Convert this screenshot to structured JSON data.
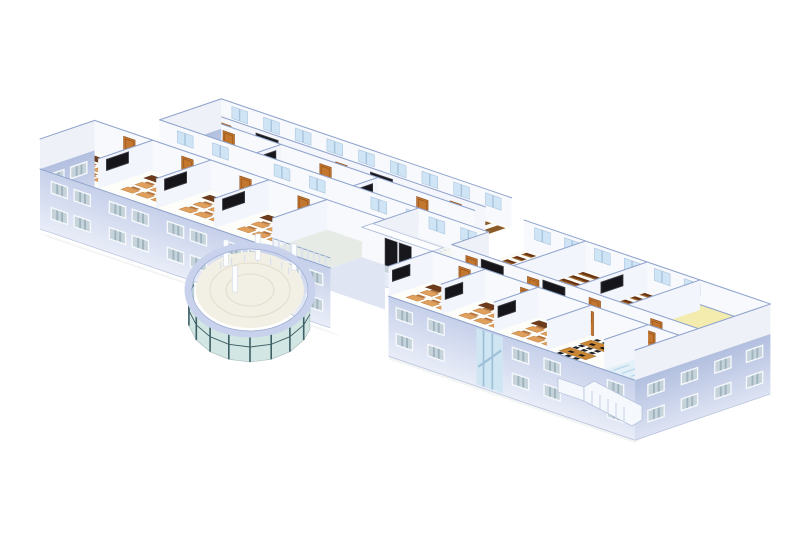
{
  "palette": {
    "edge": "#8fa3cc",
    "edgeSoft": "#b8c4dd",
    "wallIn": "#f7f9fd",
    "wallIn2": "#eef1f8",
    "part": "#f2f5fb",
    "floorRoom": "#fdfdfa",
    "floorWarm": "#fbfbf6",
    "corridor": "#e6ebe6",
    "tileLine": "#ccd4cc",
    "ground": "#e3e7ee",
    "facadeHi": "#c6d0ea",
    "facadeLo": "#e9edf8",
    "facadeSideHi": "#b2bfdf",
    "facadeSideLo": "#dde3f3",
    "winFrame": "#f6f9fc",
    "winGlass": "#c6d3da",
    "winStripe": "#9fb4be",
    "winHi": "#cfe4f4",
    "door": "#c2762e",
    "doorDark": "#8e4f1b",
    "board": "#15151a",
    "tdesk": "#6e3c1d",
    "deskTop": "#e0a05c",
    "deskSide": "#b4733a",
    "lseat": "#6a3312",
    "lseatHi": "#a06a2f",
    "shelf": "#8a5a28",
    "otable": "#c98736",
    "ochair": "#1e1e22",
    "screen": "#2456c4",
    "chairRed": "#d23c22",
    "plant": "#3c9c40",
    "plantPot": "#a66a2e",
    "yellowFloor": "#faf3c8",
    "yellowWall": "#f3ecae",
    "glass": "#cfe4e1",
    "mullion": "#3d5f66",
    "ring": "#c8d2ec",
    "ringEdge": "#9fb0d4",
    "column": "#fcfdff",
    "railing": "#d9e0ee",
    "stair": "#f5f8fd",
    "mat": "#f0e87a",
    "matEdge": "#d8cf4e",
    "canopy": "#fcfdff",
    "glazing": "#cfe6f2",
    "glazingStripe": "#9fc0d8",
    "washFloor": "#e4f0f7",
    "washStall": "#badbeb",
    "background": "#ffffff"
  },
  "scene": {
    "background": "#ffffff",
    "view": "isometric cutaway rendering of a school building, top floor exposed",
    "left_front_wing": {
      "rooms": [
        {
          "type": "classroom",
          "furniture": [
            "student-desks",
            "teacher-desk",
            "blackboard"
          ]
        },
        {
          "type": "classroom",
          "furniture": [
            "student-desks",
            "teacher-desk",
            "blackboard"
          ]
        },
        {
          "type": "classroom",
          "furniture": [
            "student-desks",
            "teacher-desk",
            "blackboard"
          ]
        },
        {
          "type": "classroom",
          "furniture": [
            "student-desks",
            "teacher-desk",
            "blackboard"
          ]
        },
        {
          "type": "open-deck",
          "furniture": [
            "railing"
          ]
        }
      ],
      "facade": {
        "window_rows": 2,
        "window_columns": 10
      }
    },
    "left_rear_wing": {
      "front_row": [
        {
          "type": "classroom",
          "furniture": [
            "student-desks",
            "teacher-desk",
            "blackboard"
          ]
        },
        {
          "type": "classroom",
          "furniture": [
            "student-desks",
            "teacher-desk",
            "blackboard"
          ]
        },
        {
          "type": "classroom",
          "furniture": [
            "student-desks",
            "teacher-desk",
            "blackboard"
          ]
        }
      ],
      "rear_row": [
        {
          "type": "lecture-hall",
          "furniture": [
            "tiered-seats",
            "blackboard"
          ]
        },
        {
          "type": "lecture-hall",
          "furniture": [
            "tiered-seats",
            "blackboard"
          ]
        },
        {
          "type": "library-room",
          "furniture": [
            "shelves"
          ]
        }
      ],
      "corridor": true
    },
    "entrance": {
      "features": [
        "double-black-doors",
        "canopy",
        "yellow-floor-mats",
        "staircase"
      ]
    },
    "rotunda": {
      "features": [
        "curved-glass-curtain-wall",
        "ring-beam",
        "columns",
        "tiled-lobby-floor",
        "railing"
      ]
    },
    "right_wing": {
      "front_row": [
        {
          "type": "classroom",
          "furniture": [
            "student-desks",
            "teacher-desk",
            "blackboard"
          ]
        },
        {
          "type": "classroom",
          "furniture": [
            "student-desks",
            "teacher-desk",
            "blackboard"
          ]
        },
        {
          "type": "classroom",
          "furniture": [
            "student-desks",
            "teacher-desk",
            "blackboard"
          ]
        },
        {
          "type": "office",
          "furniture": [
            "wood-tables",
            "black-chairs",
            "monitors"
          ]
        },
        {
          "type": "washroom",
          "furniture": [
            "stalls"
          ]
        }
      ],
      "rear_row": [
        {
          "type": "lecture-hall",
          "furniture": [
            "tiered-seats"
          ]
        },
        {
          "type": "lecture-hall",
          "furniture": [
            "tiered-seats"
          ]
        },
        {
          "type": "classroom",
          "furniture": [
            "student-desks"
          ]
        },
        {
          "type": "lounge-yellow",
          "furniture": [
            "desks",
            "red-chairs",
            "plants",
            "blue-monitors"
          ]
        },
        {
          "type": "lounge-yellow",
          "furniture": [
            "desks",
            "red-chairs",
            "plants",
            "blue-monitors"
          ]
        }
      ],
      "corridor": true,
      "facade": {
        "window_rows": 2,
        "glazed_stairwell": true
      },
      "exterior_stair": true
    }
  }
}
